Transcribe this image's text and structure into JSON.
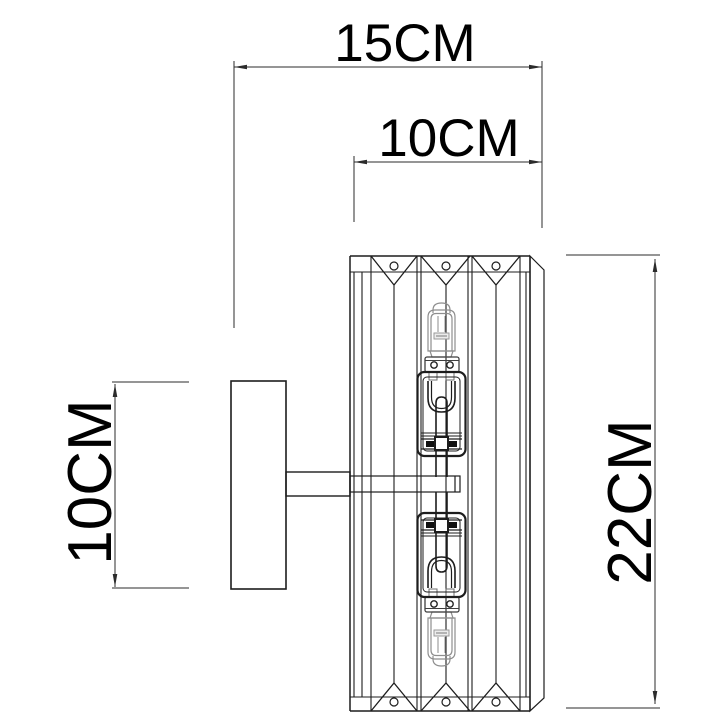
{
  "page": {
    "background": "#ffffff"
  },
  "drawing": {
    "subject": "wall-mounted crystal sconce, dimensioned technical line drawing",
    "line_color": "#1d1d1d",
    "glass_line_color": "#8e8e8e",
    "dimension_color": "#2b2b2b",
    "dimensions": {
      "overall_projection": {
        "label": "15CM",
        "orientation": "horizontal"
      },
      "body_width": {
        "label": "10CM",
        "orientation": "horizontal"
      },
      "backplate_height": {
        "label": "10CM",
        "orientation": "vertical"
      },
      "body_height": {
        "label": "22CM",
        "orientation": "vertical"
      }
    }
  }
}
